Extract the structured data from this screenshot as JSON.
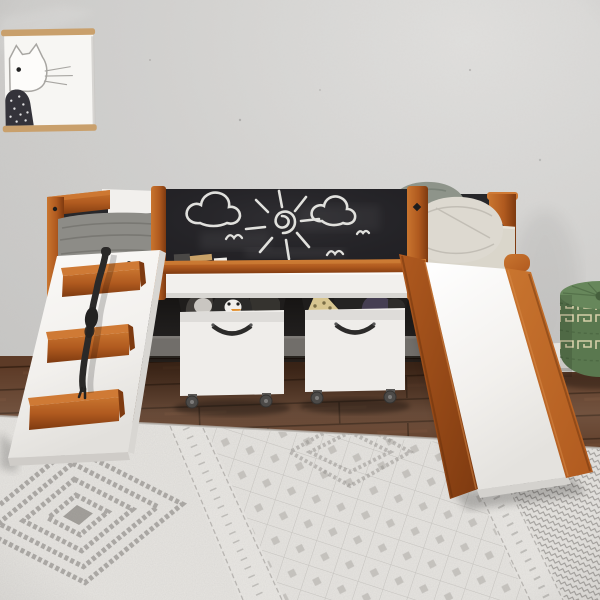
{
  "scene": {
    "title": "Kids low loft bed with chalkboard guard panel, climbing ramp with rope, slide and two rolling toy storage boxes on a patterned rug",
    "canvas": {
      "width": 600,
      "height": 600
    },
    "colors": {
      "wall": "#d2d1cf",
      "wall_light": "#e0dfdd",
      "wall_dark": "#c3c2c0",
      "wood": "#b05a1f",
      "wood_light": "#c9752f",
      "wood_dark": "#7e3a10",
      "white_paint": "#f2f0ed",
      "white_shade": "#d8d6d2",
      "chalkboard": "#232226",
      "chalk": "#ebebe7",
      "black_panel": "#27272a",
      "blanket": "#8d8c87",
      "blanket_fold": "#74736e",
      "mattress": "#dad6cb",
      "pillow_green": "#8e948a",
      "pillow_beige": "#ddd9d0",
      "underbed": "#211f1e",
      "underbed_base": "#716e6a",
      "baseboard": "#e6e4e0",
      "floor": "#5d3b27",
      "floor_gap": "#3a2314",
      "floor_light": "#6d4730",
      "rug": "#e7e5e1",
      "rug_ink": "#8f8c88",
      "rug_band": "#eae8e4",
      "rope": "#2a2928",
      "handle": "#2c2b2a",
      "box_white": "#efedea",
      "box_inner": "#1f1d1c",
      "caster": "#4c4a48",
      "penguin": "#2b2a29",
      "penguin_beak": "#e2902f",
      "plush_gray": "#c9c6c1",
      "plush_dark": "#413e3b",
      "hat_gold": "#d8c691",
      "hat_dark": "#6b5f3a",
      "plush_purple": "#453e52",
      "pouf": "#5a784f",
      "pouf_top": "#67875b",
      "pouf_stitch": "#d6cfa9",
      "pouf_dark": "#46603d",
      "frame_wood": "#c9a06c",
      "cat_line": "#a8a6a2",
      "cat_body": "#34333a"
    },
    "objects": [
      {
        "name": "framed-cat-poster",
        "description": "Minimalist cat art print hung on wood poster rails"
      },
      {
        "name": "loft-bed",
        "description": "Low loft bed, white panels with cherry wood posts"
      },
      {
        "name": "chalkboard-panel",
        "description": "Black chalkboard guard rail with chalk drawings"
      },
      {
        "name": "climbing-ramp",
        "description": "White climbing ramp with three cherry wood cleats and a knotted black rope"
      },
      {
        "name": "slide",
        "description": "White slide with cherry wood side rails"
      },
      {
        "name": "storage-box-left",
        "description": "White rolling toy box holding a penguin plush"
      },
      {
        "name": "storage-box-right",
        "description": "White rolling toy box holding a gold party hat and dark plush toys"
      },
      {
        "name": "mattress-and-pillows",
        "description": "Beige mattress, sage green and beige pillows, gray blanket"
      },
      {
        "name": "green-pouf",
        "description": "Green knitted drum pouf with cream greek-key stitching"
      },
      {
        "name": "area-rug",
        "description": "Gray and white bohemian diamond-pattern rug"
      },
      {
        "name": "wood-floor",
        "description": "Dark walnut plank floor"
      }
    ],
    "chalkboard_drawings": [
      "cloud-left",
      "sun-with-rays",
      "cloud-right",
      "three-birds",
      "chalk-sticks-on-ledge"
    ]
  }
}
